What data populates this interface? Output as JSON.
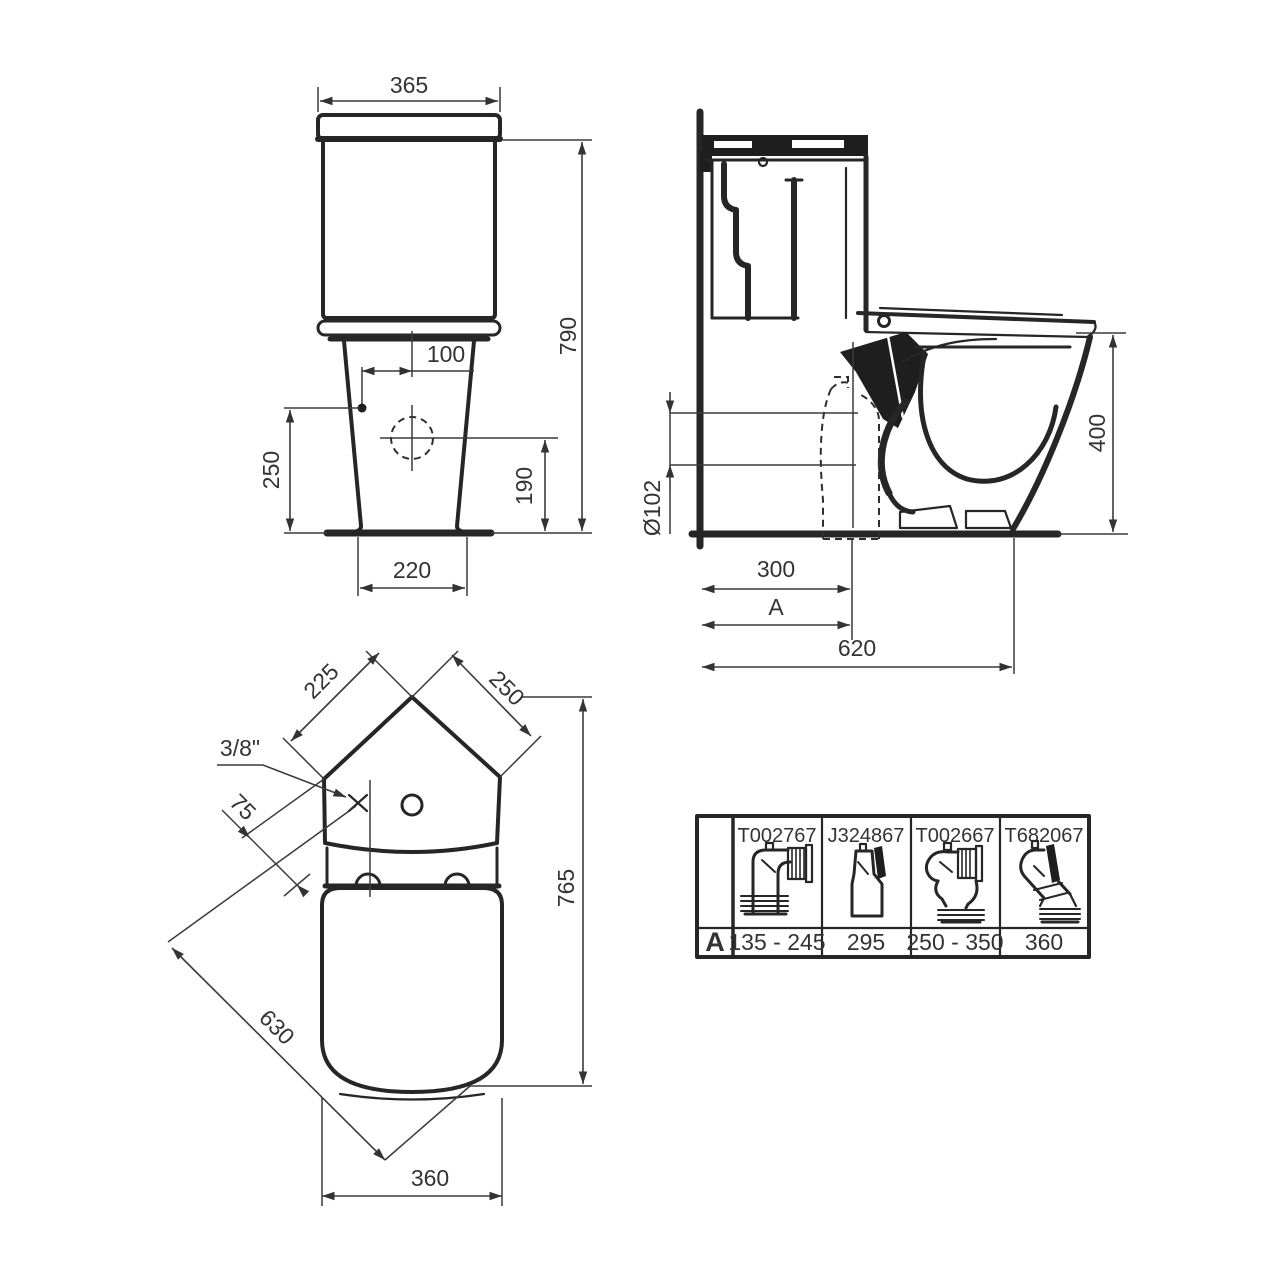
{
  "front_view": {
    "tank_width": "365",
    "total_height": "790",
    "inlet_offset_x": "100",
    "inlet_height": "250",
    "hole_height": "190",
    "base_width": "220"
  },
  "side_view": {
    "outlet_diameter": "Ø102",
    "outlet_distance": "300",
    "rough_in": "A",
    "total_depth": "620",
    "rim_height": "400"
  },
  "top_view": {
    "tank_edge_left": "225",
    "tank_edge_right": "250",
    "water_inlet": "3/8\"",
    "inlet_offset": "75",
    "total_depth": "765",
    "diagonal_depth": "630",
    "seat_width": "360"
  },
  "adapter_table": {
    "row_label": "A",
    "columns": [
      {
        "part_number": "T002767",
        "value": "135 - 245"
      },
      {
        "part_number": "J324867",
        "value": "295"
      },
      {
        "part_number": "T002667",
        "value": "250 - 350"
      },
      {
        "part_number": "T682067",
        "value": "360"
      }
    ]
  }
}
